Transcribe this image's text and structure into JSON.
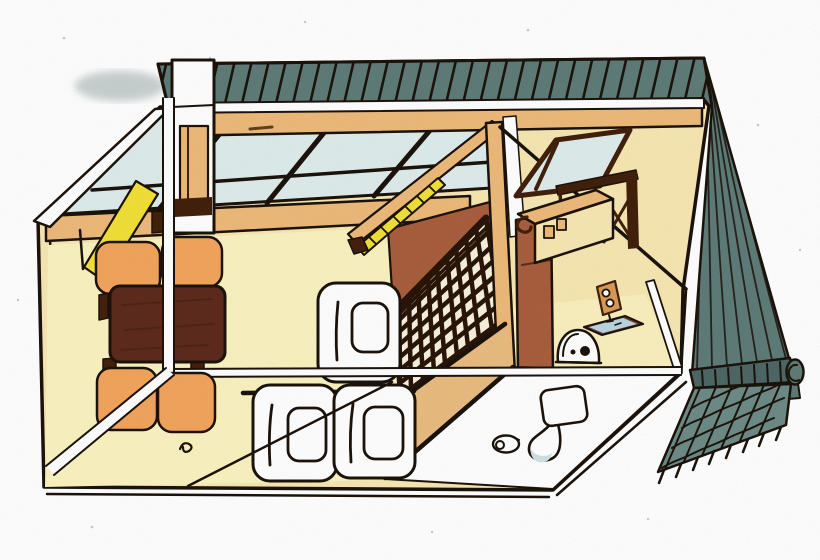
{
  "canvas": {
    "width": 820,
    "height": 560
  },
  "scene": {
    "description": "Hand-drawn colored-pencil cutaway illustration of a small attic apartment: dark slate tiled roof band on top and sloped tile roof with ridge cap on the right; interior with skylight window band, tatami room with dark low table and four orange floor cushions, white chimney shaft, yellow sloped panel, stairwell with dark lattice railing and wooden loft ladder, corner post, tall sienna cabinet, wall shelf and kitchen counter, dormer window, power outlet, rice cooker, blue tray, three white futon bedding sets, wooden step strip, and a white bathroom floor with toilet and toilet paper roll.",
    "objects": [
      "tiled-roof-band",
      "right-roof-slope",
      "ridge-cap",
      "ridge-ornament",
      "skylight-windows",
      "chimney-shaft",
      "yellow-panel",
      "ceiling-beam",
      "wall-plate-beam",
      "low-table",
      "floor-cushions-x4",
      "stairwell-wall",
      "sloped-roof-beam",
      "loft-ladder",
      "stair-lattice-railing",
      "corner-post",
      "tall-cabinet",
      "dormer-window",
      "wall-shelf",
      "kitchen-counter",
      "wall-hook",
      "power-outlet",
      "rice-cooker",
      "serving-tray",
      "futon-bedding-x3",
      "wood-step-floor",
      "bathroom-floor",
      "toilet",
      "toilet-paper-roll",
      "floor-cord",
      "cutaway-section-lines"
    ]
  },
  "colors": {
    "paper": "#ffffff",
    "ink": "#1c140c",
    "smudge": "#93a3a1",
    "roof_slate": "#5f7c79",
    "roof_slate_dark": "#4e6866",
    "roof_slate_light": "#6e8b88",
    "glass": "#dfecec",
    "wood_tan": "#edba7a",
    "wall_cream": "#f7e7b2",
    "floor_pale": "#faf3c0",
    "floor_wood": "#e9bc80",
    "bright_yellow": "#f2e038",
    "cushion_orange": "#f2a55c",
    "table_brown": "#5e2b1e",
    "table_leg": "#46200f",
    "sienna": "#a95f3e",
    "walnut": "#42210b",
    "lattice_bg": "#f7f1dd",
    "lattice_dark": "#2a1609",
    "white_obj": "#ffffff",
    "shade_blue": "#cfe2e6",
    "tray_blue": "#b9d6e2",
    "tray_rim": "#7a4526",
    "outlet_tan": "#d99a55"
  }
}
